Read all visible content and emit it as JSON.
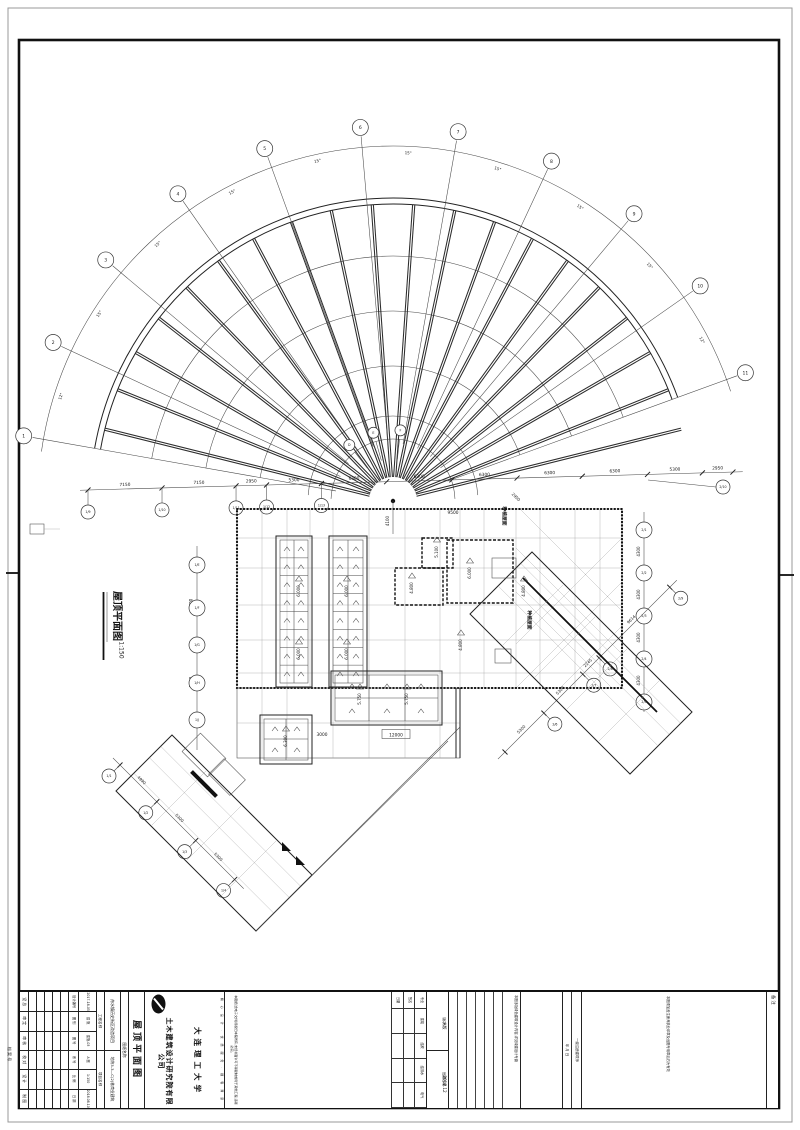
{
  "sheet": {
    "margin_note": "档 案 号"
  },
  "drawing": {
    "title": "屋顶平面图",
    "scale": "1:150",
    "fan": {
      "bubbles": [
        "1",
        "2",
        "3",
        "4",
        "5",
        "6",
        "7",
        "8",
        "9",
        "10",
        "11"
      ],
      "angles": [
        "12°",
        "15°",
        "15°",
        "15°",
        "15°",
        "15°",
        "15°",
        "15°",
        "15°",
        "12°"
      ],
      "inner_bubbles": [
        "D",
        "E",
        "F"
      ],
      "extra_bubble": "2/10"
    },
    "dims": {
      "top": [
        "7150",
        "7150",
        "2950",
        "5300",
        "6300",
        "6300",
        "6300",
        "6300",
        "6300",
        "5300",
        "2950"
      ],
      "top_bubbles": [
        "1/9",
        "1/10",
        "1/11",
        "1/12",
        "1/13"
      ],
      "left": [
        "8600",
        "8600"
      ],
      "left_bubbles": [
        "1/E",
        "1/F",
        "1/G",
        "1/H",
        "1/J"
      ],
      "right": [
        "4300",
        "4300",
        "4300",
        "4300"
      ],
      "right_bubbles": [
        "2/1",
        "2/2",
        "2/3",
        "2/4",
        "2/5"
      ],
      "sw": [
        "4990",
        "5300",
        "5300"
      ],
      "sw_bubbles": [
        "1/1",
        "1/2",
        "1/3",
        "1/4"
      ],
      "se": [
        "5300",
        "5300",
        "2245",
        "9614"
      ],
      "se_bubbles": [
        "2/6",
        "2/7",
        "2/8",
        "2/9"
      ],
      "misc": [
        "4100",
        "9500",
        "2950",
        "3000",
        "12000"
      ]
    },
    "elevations": [
      "6.000",
      "6.000",
      "6.000",
      "6.000",
      "4.800",
      "5.100",
      "6.000",
      "5.750",
      "5.750",
      "6.300",
      "4.800",
      "4.800"
    ],
    "room_labels": [
      "种植屋面",
      "种植屋面"
    ]
  },
  "titleblock": {
    "sign_labels": [
      "设 总",
      "审 定",
      "审 核",
      "校 对",
      "设 计",
      "制 图"
    ],
    "fields": [
      [
        "设计编号",
        "2017-18-05"
      ],
      [
        "图 别",
        "建 施"
      ],
      [
        "图 号",
        "建施-03"
      ],
      [
        "系 号",
        "A 图"
      ],
      [
        "比 例",
        "1:150"
      ],
      [
        "日 期",
        "2018.08.10"
      ]
    ],
    "project_label": "工程名称",
    "project_value": "舟水镇历史街区改造项目",
    "item_label": "项目名称",
    "item_value": "地块3-3—C(2)栋商业建筑",
    "sheet_label": "图纸名称",
    "sheet_value": "屋顶平面图",
    "company": {
      "slogan": "精 心 设 计 · 优 质 服 务 · 顾 客 满 意",
      "cn1": "大连理工大学",
      "cn2": "土木建筑设计研究院有限公司",
      "en": "Design Institute of Civil Engineering & Architecture\nof Dalian University of Technology Co., Ltd",
      "cert": "设计证书:建筑行业甲级\n证书编号:A121005994\n勘察证书:工程勘察甲级\n证书编号:B123005994",
      "addr": "地址:大连市甘井子区凌工路2号\n电话:0411-84708886\n传真:0411-84708886\n邮编:116024"
    },
    "disclaimer": "本图纸(含电子文件)版权归本院所有,未经书面许可不得复制或用于其他工程,违者必究。",
    "huiqian": {
      "r1": [
        "专业",
        "建筑",
        "结构",
        "给排水",
        "电气"
      ],
      "r2": "签名",
      "r3": "日期"
    },
    "version": {
      "label": "版次",
      "value": "A版",
      "date_label": "出图日期",
      "date": "2017.12"
    },
    "green_note": "本图涉及绿色建筑设计内容,详见绿建设计专篇",
    "reg": {
      "l1": "一级注册建筑师",
      "l2": "年    月    日"
    },
    "stamp_note": "本图须加盖注册师执业印章及出图专用章后方为有效",
    "remark_label": "备 注"
  }
}
